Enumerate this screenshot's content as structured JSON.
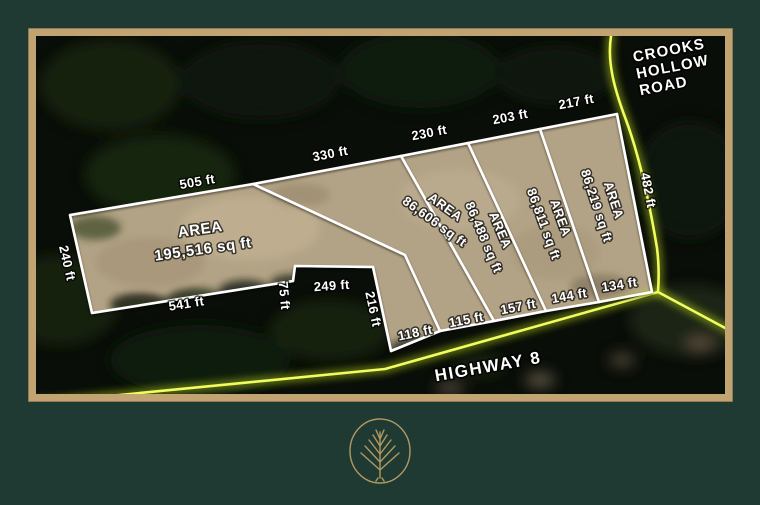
{
  "map": {
    "road_labels": {
      "crooks_line1": "CROOKS",
      "crooks_line2": "HOLLOW",
      "crooks_line3": "ROAD",
      "highway": "HIGHWAY 8"
    },
    "parcels": [
      {
        "area_word": "AREA",
        "area_value": "195,516 sq ft"
      },
      {
        "area_word": "AREA",
        "area_value": "86,606 sq ft"
      },
      {
        "area_word": "AREA",
        "area_value": "86,488 sq ft"
      },
      {
        "area_word": "AREA",
        "area_value": "86,811 sq ft"
      },
      {
        "area_word": "AREA",
        "area_value": "86,219 sq ft"
      }
    ],
    "dimensions": [
      {
        "text": "505 ft"
      },
      {
        "text": "330 ft"
      },
      {
        "text": "230 ft"
      },
      {
        "text": "203 ft"
      },
      {
        "text": "217 ft"
      },
      {
        "text": "482 ft"
      },
      {
        "text": "240 ft"
      },
      {
        "text": "541 ft"
      },
      {
        "text": "75 ft"
      },
      {
        "text": "249 ft"
      },
      {
        "text": "216 ft"
      },
      {
        "text": "118 ft"
      },
      {
        "text": "115 ft"
      },
      {
        "text": "157 ft"
      },
      {
        "text": "144 ft"
      },
      {
        "text": "134 ft"
      }
    ]
  },
  "colors": {
    "background_green": "#1e3a33",
    "frame_tan": "#c2a472",
    "road_yellow": "#e8f542",
    "boundary_white": "#ffffff",
    "land_tan": "#b3a386",
    "logo_gold": "#c3a266"
  }
}
